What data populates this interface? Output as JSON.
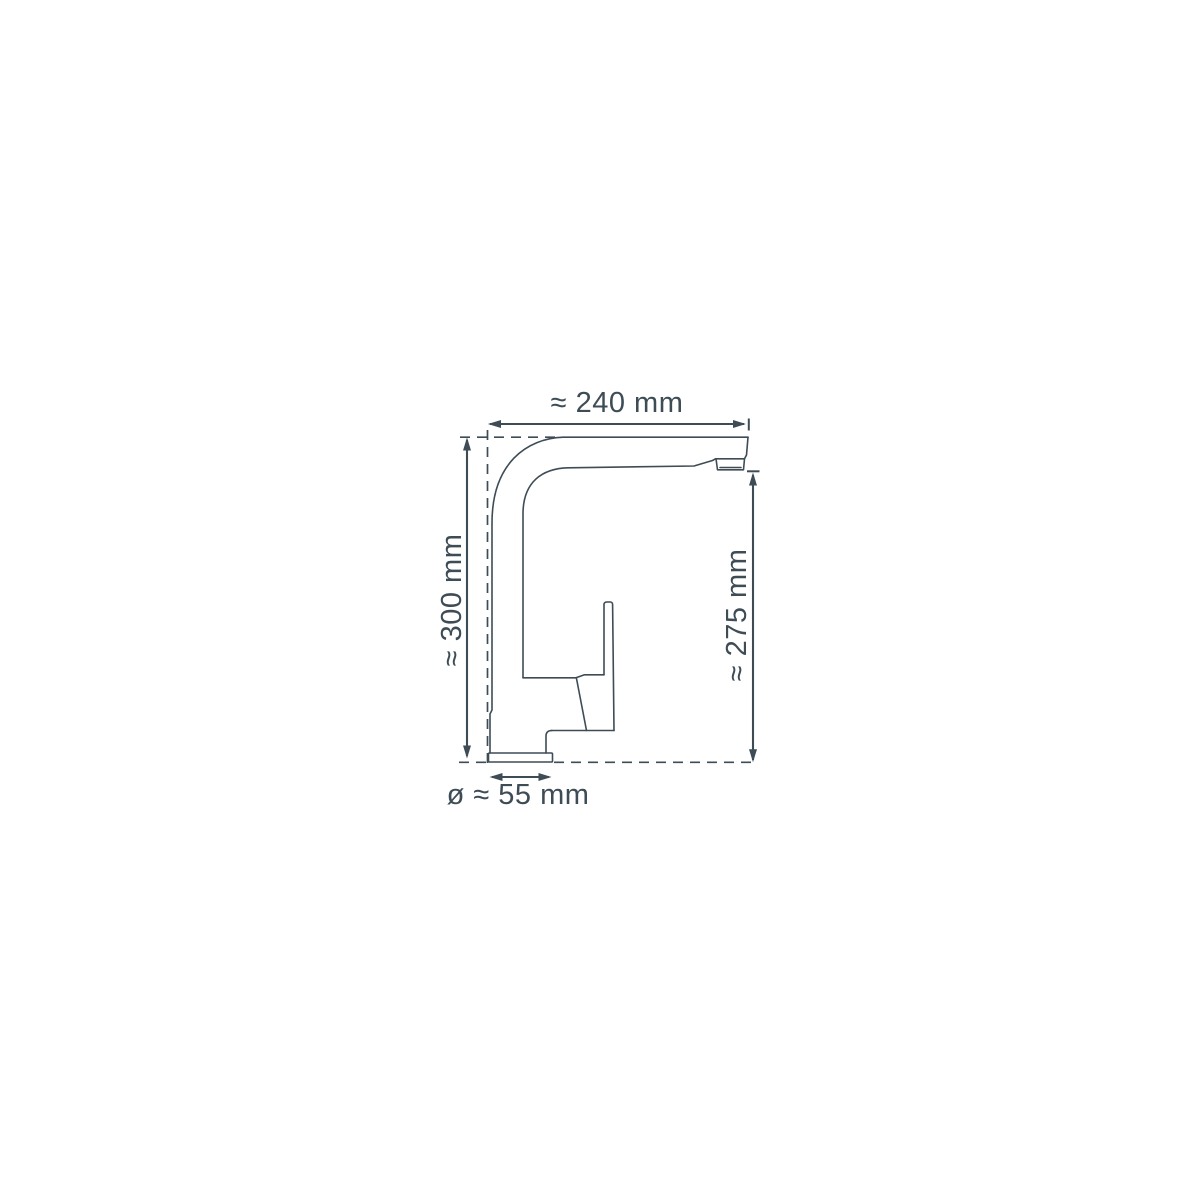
{
  "diagram": {
    "subject": "kitchen-faucet-side-view-dimension-drawing",
    "background": "#ffffff",
    "line_color": "#3e4c56",
    "labels": {
      "width_top": "≈ 240 mm",
      "height_left": "≈ 300 mm",
      "height_right": "≈ 275 mm",
      "base_diameter": "ø ≈ 55 mm"
    },
    "measurements": {
      "spout_reach_mm": 240,
      "total_height_mm": 300,
      "spout_outlet_height_mm": 275,
      "base_diameter_mm": 55
    }
  }
}
